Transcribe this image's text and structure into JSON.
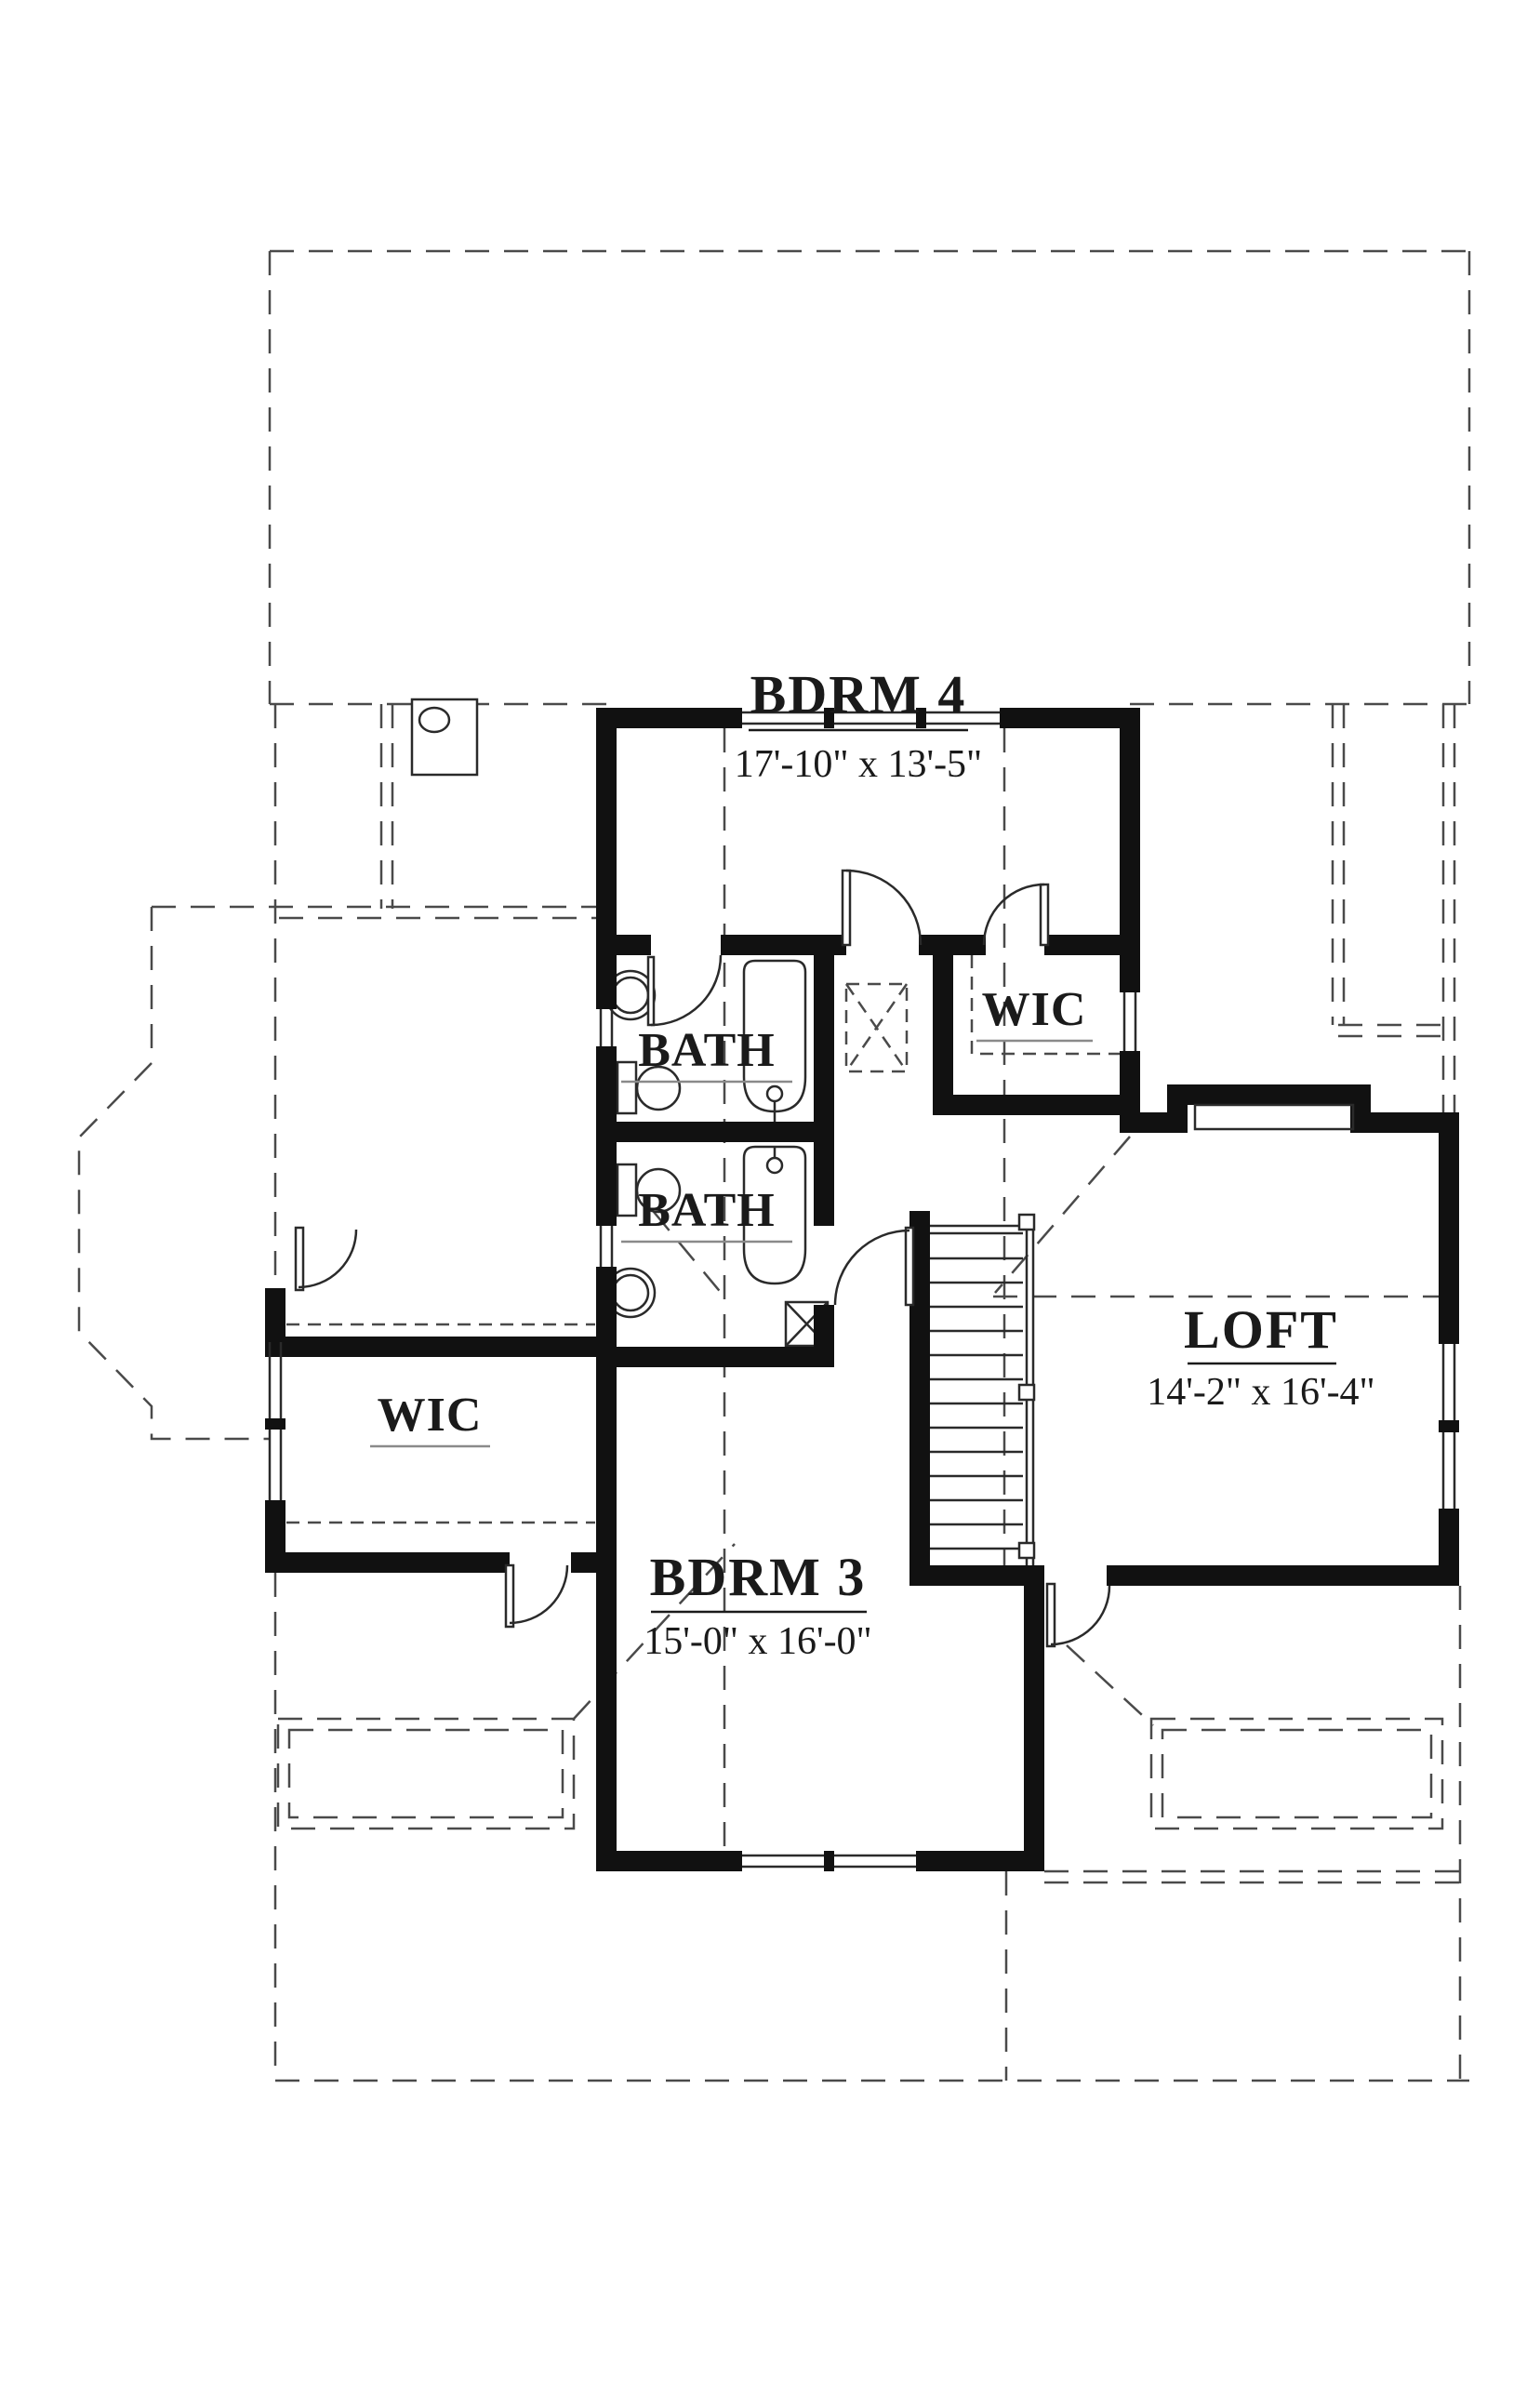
{
  "title": "Second floor plan",
  "colors": {
    "wall": "#111111",
    "thin_line": "#2a2a2a",
    "dashed_line": "#4a4a4a",
    "gray_underline": "#8a8a8a",
    "background": "#ffffff"
  },
  "rooms": {
    "bdrm4": {
      "label": "BDRM 4",
      "dims": "17'-10\" x 13'-5\""
    },
    "bath_upper": {
      "label": "BATH"
    },
    "bath_lower": {
      "label": "BATH"
    },
    "wic_upper": {
      "label": "WIC"
    },
    "wic_lower": {
      "label": "WIC"
    },
    "loft": {
      "label": "LOFT",
      "dims": "14'-2\" x 16'-4\""
    },
    "bdrm3": {
      "label": "BDRM 3",
      "dims": "15'-0\" x 16'-0\""
    }
  }
}
